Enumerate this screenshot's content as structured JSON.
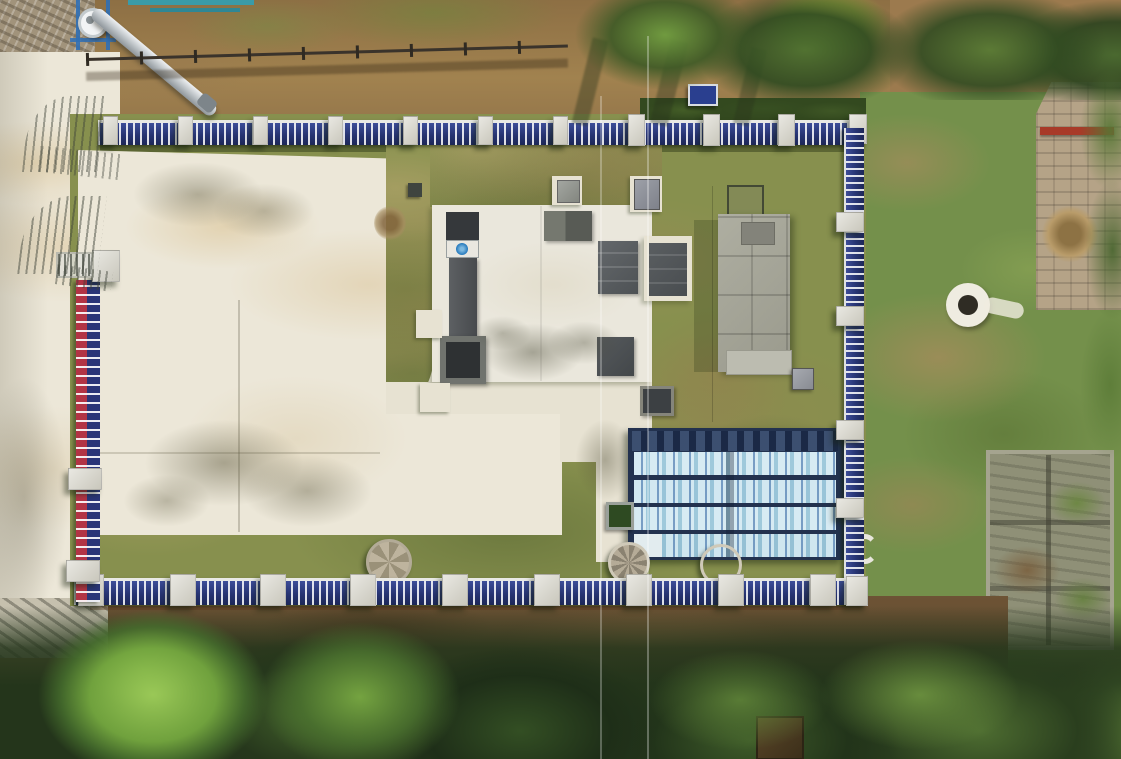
{
  "scene": {
    "title": "Aerial drone photograph of a small fenced water-treatment station",
    "description": "Top-down view of a compound enclosed by a blue-and-white picket fence with concrete posts. Inside: a large cream concrete yard, a white equipment pad with dark screening channels and panels, a grey flat-roofed plant building, and four rows of equipment wrapped in light-blue protective film. Outside: dirt slopes, dense green trees, a stone retaining wall, ruined masonry and round manhole wells. A galvanized discharge chute enters at the top-left gate.",
    "setting": "rural hillside, morning sun from the east casting shadows to the south-west",
    "palette": {
      "pavement": "#ece7d8",
      "pad_white": "#eae7dc",
      "grass_olive": "#87904e",
      "grass_dry": "#b7a96f",
      "fence_navy": "#273472",
      "fence_red": "#b23445",
      "fence_post_concrete": "#d8d6cd",
      "tank_film_blue": "#c8e4ef",
      "tank_film_shadow": "#8fc3da",
      "tank_base_navy": "#1b2946",
      "building_roof_grey": "#a6a699",
      "dark_equipment": "#4a4e51",
      "dirt_brown": "#9c7a4e",
      "tree_dark": "#24351b",
      "tree_bright": "#8fbf4f",
      "stone_wall": "#b5a387",
      "ruin_grey": "#8f9077",
      "pipe_red": "#a83a28",
      "logo_blue": "#2277bb",
      "chute_metal": "#cdd2d5"
    },
    "elements": {
      "compound": "fenced treatment-station yard",
      "top_fence": "north blue picket fence with concrete posts",
      "right_fence": "east blue picket fence",
      "bottom_fence": "south blue picket fence",
      "left_fence": "west red-and-blue fence",
      "entrance_gates": "ornate metal gates casting shadows on pavement",
      "chute": "galvanized metal discharge chute",
      "equipment_pad": "white concrete pad with screening channel and dark panels",
      "screen_channel": "inclined dark screening channel with blue maker logo",
      "plant_building": "grey flat-roof plant building",
      "film_tanks": "four rows of equipment wrapped in blue protective film",
      "wells": "round concrete manhole wells",
      "stone_wall": "beige stone retaining wall with red pipe",
      "ruins": "roofless masonry ruin overgrown with weeds",
      "trees": "dense tree canopy along the south edge",
      "cables": "thin overhead service cables crossing the site"
    }
  }
}
